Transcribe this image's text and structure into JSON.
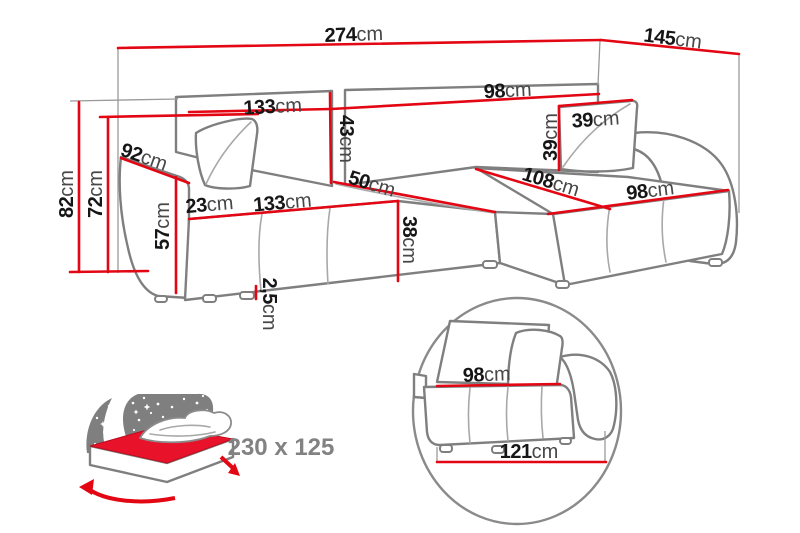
{
  "figure": {
    "type": "corner-sofa-dimension-diagram",
    "unit_default": "cm"
  },
  "dims": {
    "total_width": {
      "v": "274",
      "u": "cm"
    },
    "total_depth": {
      "v": "145",
      "u": "cm"
    },
    "backrest_left_width": {
      "v": "133",
      "u": "cm"
    },
    "backrest_right_width": {
      "v": "98",
      "u": "cm"
    },
    "backrest_height": {
      "v": "43",
      "u": "cm"
    },
    "height_total": {
      "v": "82",
      "u": "cm"
    },
    "height_backrest": {
      "v": "72",
      "u": "cm"
    },
    "arm_depth": {
      "v": "92",
      "u": "cm"
    },
    "arm_height": {
      "v": "57",
      "u": "cm"
    },
    "arm_width": {
      "v": "23",
      "u": "cm"
    },
    "seat_width": {
      "v": "133",
      "u": "cm"
    },
    "seat_depth": {
      "v": "50",
      "u": "cm"
    },
    "seat_height": {
      "v": "38",
      "u": "cm"
    },
    "leg_clearance": {
      "v": "2,5",
      "u": "cm"
    },
    "pillow_height": {
      "v": "39",
      "u": "cm"
    },
    "pillow_width": {
      "v": "39",
      "u": "cm"
    },
    "chaise_length": {
      "v": "108",
      "u": "cm"
    },
    "chaise_width": {
      "v": "98",
      "u": "cm"
    }
  },
  "detail": {
    "module_seat_width": {
      "v": "98",
      "u": "cm"
    },
    "module_total_width": {
      "v": "121",
      "u": "cm"
    }
  },
  "sleeper": {
    "size": "230 x 125"
  },
  "colors": {
    "dimension_red": "#e30613",
    "outline_gray": "#7f7f7f",
    "text_black": "#161616",
    "muted_gray": "#828282",
    "mattress_red": "#e8132b"
  }
}
